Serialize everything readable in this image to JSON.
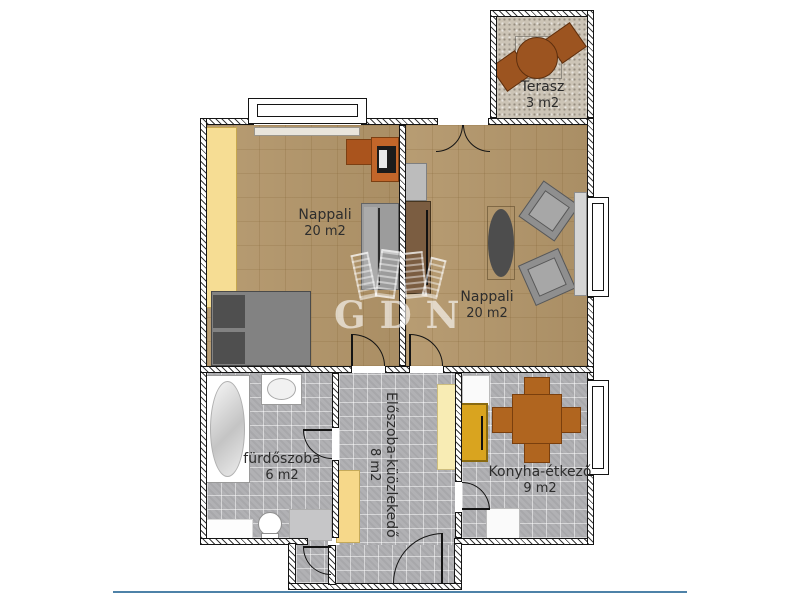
{
  "plan": {
    "watermark_text": "GDN",
    "rooms": [
      {
        "name": "Nappali",
        "area": "20 m2"
      },
      {
        "name": "Nappali",
        "area": "20 m2"
      },
      {
        "name": "Terasz",
        "area": "3 m2"
      },
      {
        "name": "fürdőszoba",
        "area": "6 m2"
      },
      {
        "name": "Előszoba-küözlekedő",
        "area": "8 m2"
      },
      {
        "name": "Konyha-étkező",
        "area": "9 m2"
      }
    ],
    "colors": {
      "parquet": "#b3966a",
      "tile": "#b1b1b4",
      "terrace": "#ccc4b6",
      "wardrobe_yellow": "#f6dd94",
      "desk_orange": "#c2662a",
      "sofa_gray": "#9c9c9c",
      "bed_gray": "#828282",
      "kitchen_set_brown": "#b0651f",
      "cabinet_amber": "#d9a41f",
      "hall_cabinet_yellow": "#f6d88a",
      "label_text": "#2d2d2d",
      "footer_line_blue": "#4e82a8",
      "watermark_white": "rgba(255,255,255,0.62)"
    },
    "furniture": [
      "wardrobe",
      "double-bed",
      "desk",
      "desk-chair",
      "printer",
      "sofa",
      "tv-cabinet",
      "wardrobe-brown",
      "oval-table",
      "armchair",
      "armchair",
      "sideboard",
      "patio-table",
      "patio-chair",
      "patio-chair",
      "bathtub",
      "sink",
      "toilet",
      "bath-mat",
      "hall-cabinet",
      "hall-cabinet",
      "fridge-cabinet",
      "dining-table",
      "dining-chair",
      "dining-chair",
      "dining-chair",
      "dining-chair",
      "kitchen-appliance",
      "kitchen-appliance"
    ]
  }
}
